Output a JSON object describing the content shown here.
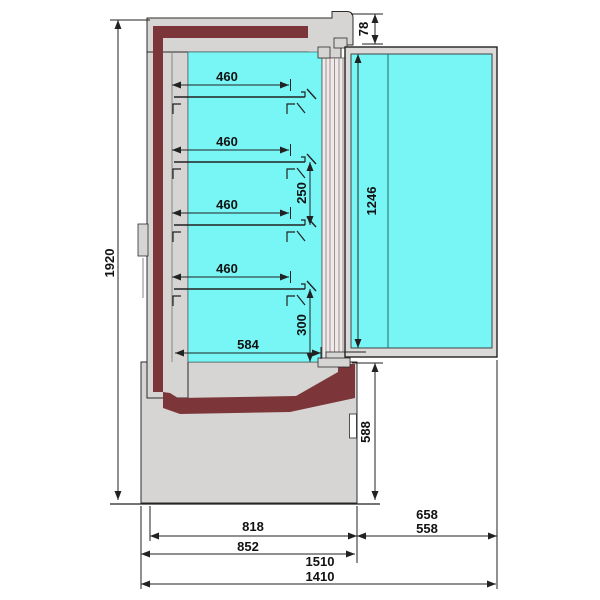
{
  "colors": {
    "interior": "#78f6f6",
    "insulation": "#7c3639",
    "shell": "#d7d5d3",
    "door_frame": "#dcdad8",
    "line": "#222222"
  },
  "dims": {
    "overall_height": "1920",
    "shelf_depths": [
      "460",
      "460",
      "460",
      "460"
    ],
    "shelf_spacing": "250",
    "bottom_shelf_clearance": "300",
    "interior_bottom_depth": "584",
    "door_top_offset": "78",
    "door_glass_height": "1246",
    "base_height": "588",
    "body_depth_inner": "818",
    "body_depth": "852",
    "door_open_depth_a": "658",
    "door_open_depth_b": "558",
    "total_depth_a": "1510",
    "total_depth_b": "1410"
  }
}
